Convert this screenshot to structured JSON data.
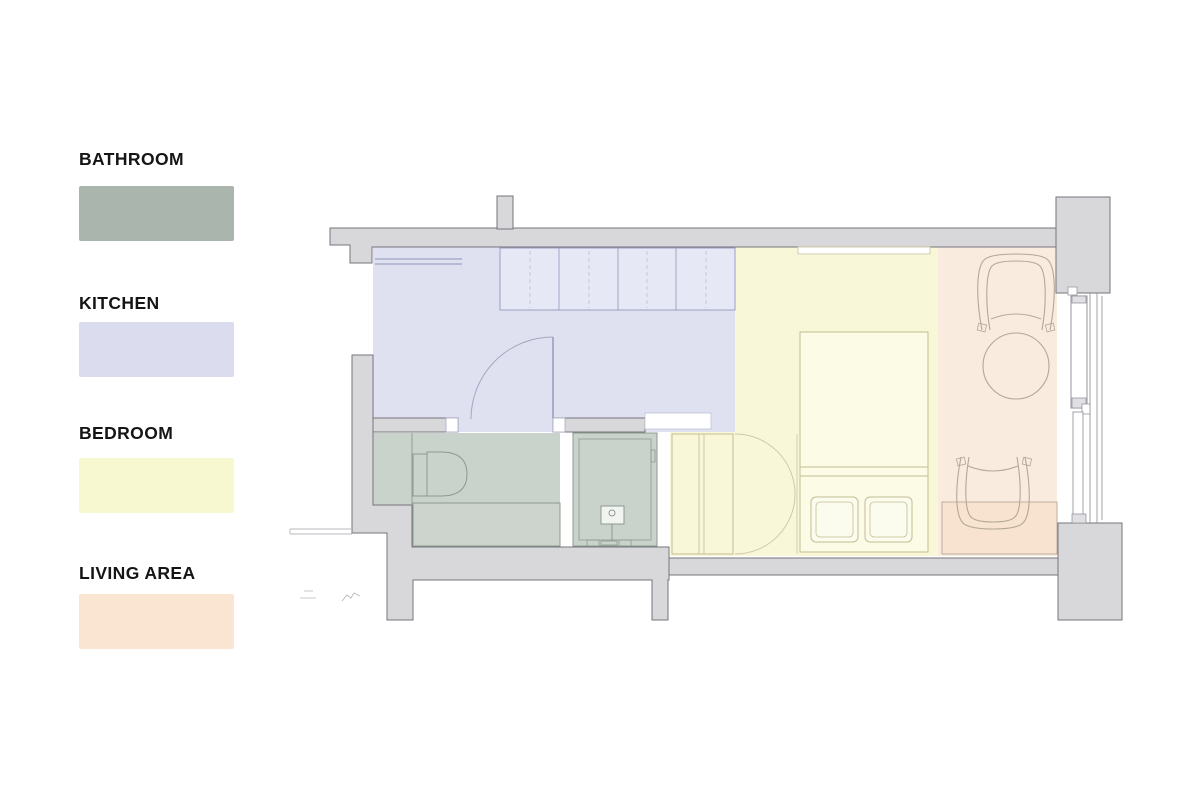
{
  "legend": {
    "items": [
      {
        "label": "BATHROOM",
        "color": "#a9b5ad"
      },
      {
        "label": "KITCHEN",
        "color": "#dbddee"
      },
      {
        "label": "BEDROOM",
        "color": "#f8f8d0"
      },
      {
        "label": "LIVING AREA",
        "color": "#f9e5d2"
      }
    ]
  },
  "colors": {
    "wall": "#d8d8db",
    "wall_stroke": "#75757c",
    "kitchen": "#dfe1f0",
    "bathroom": "#c9d2cb",
    "bedroom": "#f8f8d9",
    "living": "#f9ecdf",
    "desk": "#f7e3d0",
    "bed": "#fbfbe6",
    "pillow": "#fcfcee",
    "vanity": "#ccd4cd",
    "cabinets": "#e6e8f5",
    "shower_unit": "#f2f4f1",
    "white": "#ffffff",
    "window_cap": "#e0e0e4"
  },
  "plan": {
    "rooms": [
      "bathroom",
      "kitchen",
      "bedroom",
      "living-area"
    ],
    "fixtures": [
      "entry-door",
      "upper-cabinets",
      "counter",
      "toilet",
      "vanity-counter",
      "shower",
      "shower-fixture",
      "wardrobe",
      "bifold-doors",
      "bed",
      "pillows",
      "wall-shelf",
      "armchair-top",
      "armchair-bottom",
      "round-table",
      "desk",
      "window",
      "wall-columns"
    ]
  }
}
